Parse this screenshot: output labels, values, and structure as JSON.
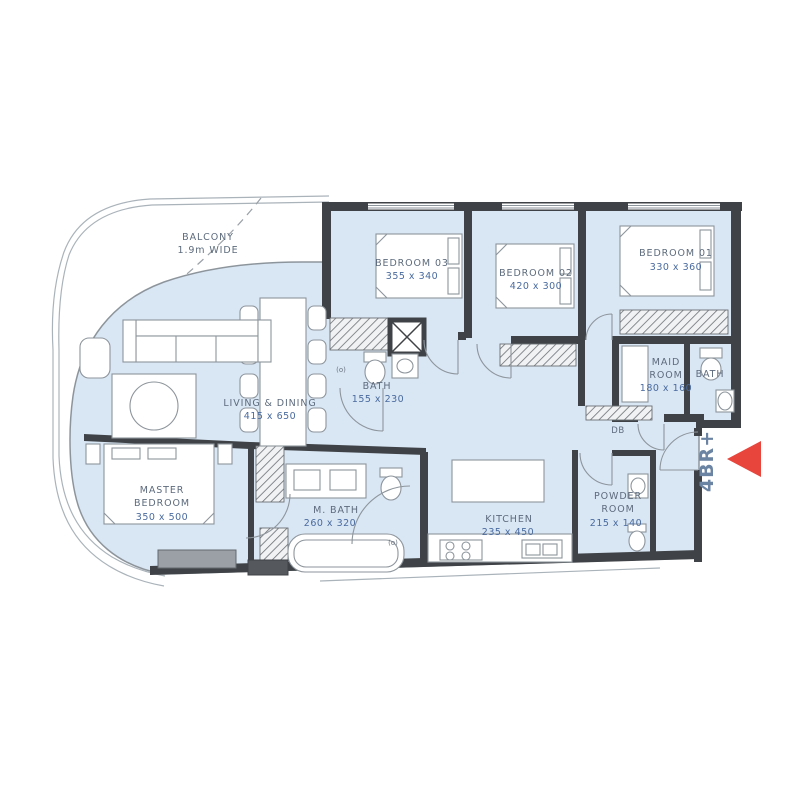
{
  "unit": {
    "type_label": "4BR+"
  },
  "colors": {
    "floor_fill": "#d9e6f4",
    "wall": "#3f4347",
    "room_name_text": "#5d6b7d",
    "room_dims_text": "#4a6b9f",
    "marker_red": "#e8453c",
    "unit_label_text": "#6c84a3"
  },
  "rooms": [
    {
      "name": "BALCONY",
      "dims": "1.9m WIDE"
    },
    {
      "name": "BEDROOM 03",
      "dims": "355 x 340"
    },
    {
      "name": "BEDROOM 02",
      "dims": "420 x 300"
    },
    {
      "name": "BEDROOM 01",
      "dims": "330 x 360"
    },
    {
      "name": "LIVING & DINING",
      "dims": "415 x 650"
    },
    {
      "name": "BATH",
      "dims": "155 x 230"
    },
    {
      "name": "MAID",
      "name2": "ROOM",
      "dims": "180 x 160"
    },
    {
      "name": "BATH"
    },
    {
      "name": "MASTER",
      "name2": "BEDROOM",
      "dims": "350 x 500"
    },
    {
      "name": "M. BATH",
      "dims": "260 x 320"
    },
    {
      "name": "KITCHEN",
      "dims": "235 x 450"
    },
    {
      "name": "POWDER",
      "name2": "ROOM",
      "dims": "215 x 140"
    }
  ],
  "labels": {
    "db": "DB",
    "door_symbol": "(o)"
  }
}
